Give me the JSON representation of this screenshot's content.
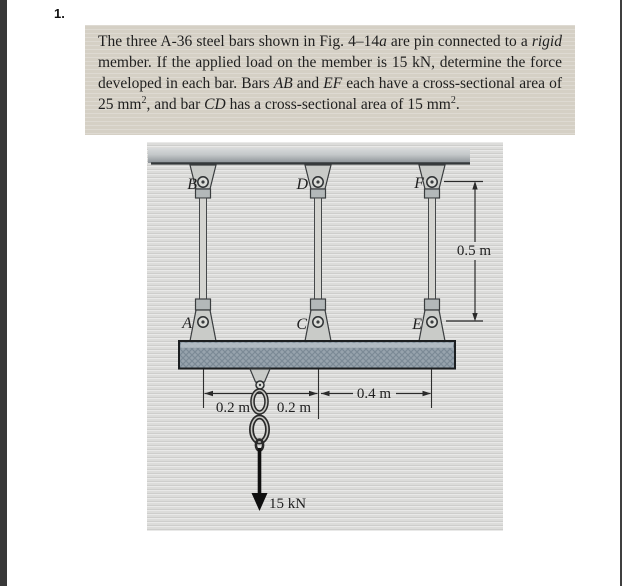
{
  "page": {
    "problem_number": "1."
  },
  "statement": {
    "s1": "The three A-36 steel bars shown in Fig. 4–14",
    "s2": "a",
    "s3": " are pin connected to a ",
    "s4": "rigid",
    "s5": " member. If the applied load on the member is 15 kN, determine the force developed in each bar. Bars ",
    "s6": "AB",
    "s7": " and ",
    "s8": "EF",
    "s9": " each have a cross-sectional area of 25 mm",
    "s10": "2",
    "s11": ", and bar ",
    "s12": "CD",
    "s13": " has a cross-sectional area of 15 mm",
    "s14": "2",
    "s15": "."
  },
  "figure": {
    "pin_labels": {
      "top_left": "B",
      "top_mid": "D",
      "top_right": "F",
      "bottom_left": "A",
      "bottom_mid": "C",
      "bottom_right": "E"
    },
    "dimensions": {
      "seg1": "0.2 m",
      "seg2": "0.2 m",
      "seg3": "0.4 m",
      "height": "0.5 m"
    },
    "load": "15 kN"
  },
  "colors": {
    "statement_bg": "#d5d0c5",
    "figure_paper": "#dcdcda",
    "ink": "#1f1f1f",
    "metal": "#c9cbc8",
    "bar_fill": "#d4d4d0",
    "member_base": "#97a3ad",
    "member_weave": "#7b8a96"
  }
}
